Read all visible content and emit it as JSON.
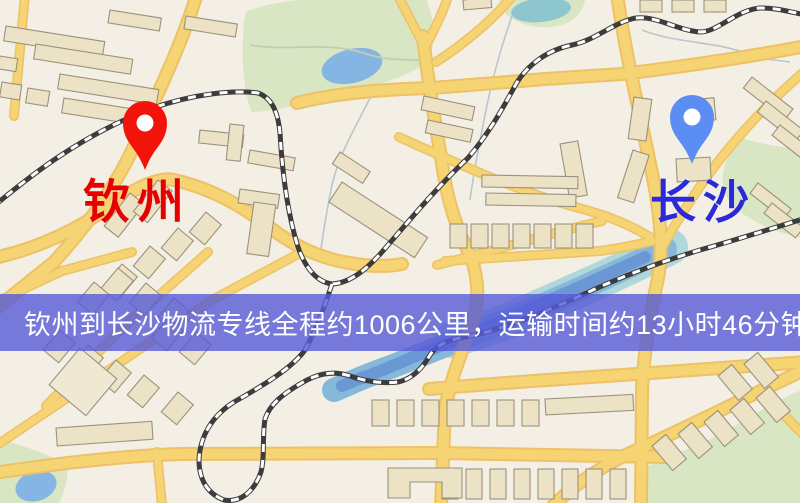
{
  "map": {
    "markers": [
      {
        "name": "qinzhou",
        "label": "钦州",
        "pin_color": "#f2140a",
        "label_color": "#e60000"
      },
      {
        "name": "changsha",
        "label": "长沙",
        "pin_color": "#5b8df2",
        "label_color": "#2a2ad8"
      }
    ],
    "banner": {
      "text": "钦州到长沙物流专线全程约1006公里，运输时间约13小时46分钟.",
      "bg_color": "rgba(86,90,215,0.8)",
      "text_color": "#ffffff"
    },
    "route": {
      "origin": "钦州",
      "destination": "长沙",
      "distance_text": "约1006公里",
      "duration_text": "约13小时46分钟"
    },
    "colors": {
      "background": "#f4efe5",
      "road_fill": "#f6d373",
      "road_casing": "#ecc267",
      "building_fill": "#ece3c6",
      "building_stroke": "#9b917c",
      "park": "#d8e6c3",
      "water_lake": "#85b5e2",
      "water_pond": "#8ec6cf",
      "railway": "#3c3c3c"
    }
  }
}
